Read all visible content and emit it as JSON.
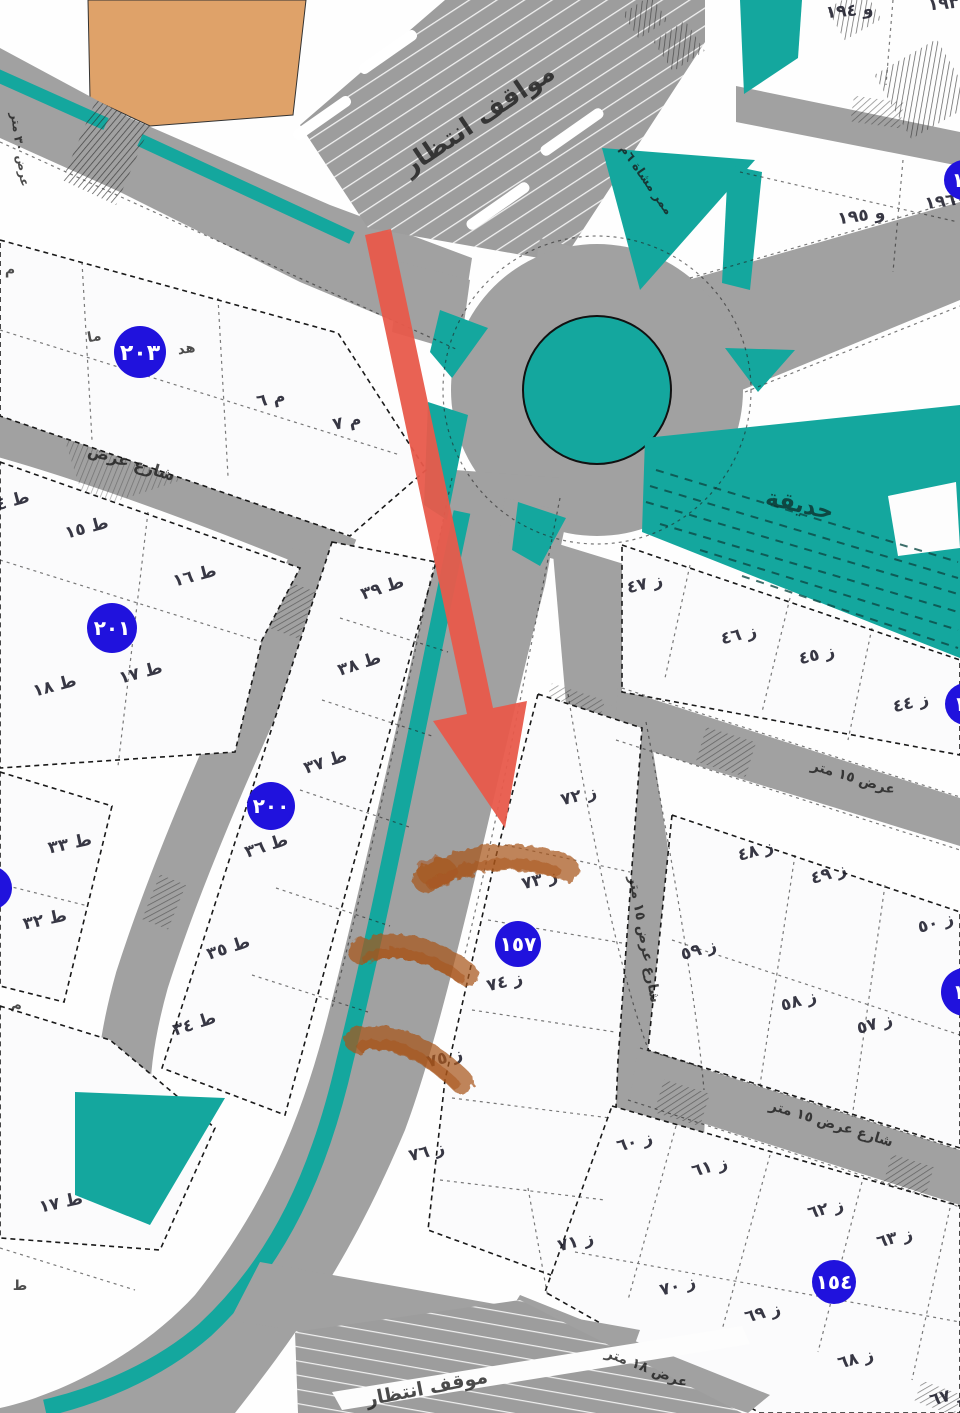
{
  "colors": {
    "road": "#a1a1a1",
    "teal": "#14a79e",
    "badge_blue": "#2012dd",
    "arrow_red": "#e85a4b",
    "highlight_orange": "#a8541b",
    "building_tan": "#dfa269",
    "plot_fill": "#fbfbfc",
    "ink": "#1f1f1f"
  },
  "labels": {
    "parking_top": "مواقف انتظار",
    "parking_bottom": "موقف انتظار",
    "garden": "حديقة",
    "street_left": "شارع عرض",
    "street_w15": "عرض ١٥ متر",
    "street_v15": "شارع عرض ١٥ متر",
    "street_lr15": "شارع عرض ١٥ متر",
    "street_w18": "عرض ١٨ متر",
    "street_w30": "عرض ٣٠ متر",
    "ped_path": "ممر مشاة ٦م"
  },
  "badges": [
    {
      "id": "203",
      "label": "٢٠٣"
    },
    {
      "id": "201",
      "label": "٢٠١"
    },
    {
      "id": "200",
      "label": "٢٠٠"
    },
    {
      "id": "157",
      "label": "١٥٧"
    },
    {
      "id": "154",
      "label": "١٥٤"
    },
    {
      "id": "right-upper",
      "label": "١٥"
    },
    {
      "id": "right-mid",
      "label": "١٥"
    },
    {
      "id": "top-right",
      "label": "١٩"
    },
    {
      "id": "left-edge",
      "label": ""
    }
  ],
  "plots": [
    {
      "id": "m-6",
      "label": "م ٦"
    },
    {
      "id": "m-7",
      "label": "م ٧"
    },
    {
      "id": "t-4",
      "label": "ط ٤"
    },
    {
      "id": "t-15",
      "label": "ط ١٥"
    },
    {
      "id": "t-16",
      "label": "ط ١٦"
    },
    {
      "id": "t-17",
      "label": "ط ١٧"
    },
    {
      "id": "t-18",
      "label": "ط ١٨"
    },
    {
      "id": "t-39",
      "label": "ط ٣٩"
    },
    {
      "id": "t-38",
      "label": "ط ٣٨"
    },
    {
      "id": "t-37",
      "label": "ط ٣٧"
    },
    {
      "id": "t-36",
      "label": "ط ٣٦"
    },
    {
      "id": "t-35",
      "label": "ط ٣٥"
    },
    {
      "id": "t-34",
      "label": "ط ٣٤"
    },
    {
      "id": "t-33",
      "label": "ط ٣٣"
    },
    {
      "id": "t-32",
      "label": "ط ٣٢"
    },
    {
      "id": "t-17b",
      "label": "ط ١٧"
    },
    {
      "id": "z-72",
      "label": "ز ٧٢"
    },
    {
      "id": "z-73",
      "label": "ز ٧٣"
    },
    {
      "id": "z-74",
      "label": "ز ٧٤"
    },
    {
      "id": "z-75",
      "label": "ز ٧٥"
    },
    {
      "id": "z-76",
      "label": "ز ٧٦"
    },
    {
      "id": "z-71",
      "label": "ز ٧١"
    },
    {
      "id": "z-47",
      "label": "ز ٤٧"
    },
    {
      "id": "z-46",
      "label": "ز ٤٦"
    },
    {
      "id": "z-45",
      "label": "ز ٤٥"
    },
    {
      "id": "z-44",
      "label": "ز ٤٤"
    },
    {
      "id": "z-48",
      "label": "ز ٤٨"
    },
    {
      "id": "z-49",
      "label": "ز ٤٩"
    },
    {
      "id": "z-50",
      "label": "ز ٥٠"
    },
    {
      "id": "z-59",
      "label": "ز ٥٩"
    },
    {
      "id": "z-58",
      "label": "ز ٥٨"
    },
    {
      "id": "z-57",
      "label": "ز ٥٧"
    },
    {
      "id": "z-60",
      "label": "ز ٦٠"
    },
    {
      "id": "z-61",
      "label": "ز ٦١"
    },
    {
      "id": "z-62",
      "label": "ز ٦٢"
    },
    {
      "id": "z-63",
      "label": "ز ٦٣"
    },
    {
      "id": "z-70",
      "label": "ز ٧٠"
    },
    {
      "id": "z-69",
      "label": "ز ٦٩"
    },
    {
      "id": "z-68",
      "label": "ز ٦٨"
    },
    {
      "id": "z-67",
      "label": "ز ٦٧"
    },
    {
      "id": "n-194",
      "label": "و ١٩٤"
    },
    {
      "id": "n-195",
      "label": "و ١٩٥"
    },
    {
      "id": "n-196",
      "label": "١٩٦"
    },
    {
      "id": "n-193",
      "label": "١٩٣"
    }
  ],
  "fragments": [
    {
      "id": "f-m1",
      "label": "م"
    },
    {
      "id": "f-ma",
      "label": "ما"
    },
    {
      "id": "f-hd",
      "label": "هد"
    },
    {
      "id": "f-m2",
      "label": "م"
    },
    {
      "id": "f-t",
      "label": "ط"
    }
  ],
  "annotations": {
    "arrow": "red-direction-arrow",
    "highlight_strokes": 3
  }
}
